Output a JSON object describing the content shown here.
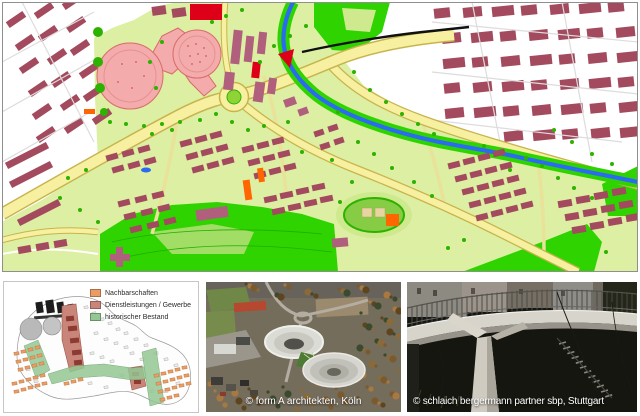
{
  "master_plan_map": {
    "description": "Urban master plan map with existing city fabric, new quarters, parks, main axis road, railway and river",
    "palette": {
      "existing_building": "#a34a5e",
      "new_building_red": "#dd0018",
      "special_building_mauve": "#b0607c",
      "planning_area": "#dcefa2",
      "park_green": "#2ed300",
      "tree_green": "#2db200",
      "road_fill": "#f6f0a0",
      "road_edge": "#c8b44e",
      "river_blue": "#2b6bf2",
      "circle_pink": "#f4abab",
      "circle_pink_edge": "#d96a6a",
      "accent_orange": "#ff6600",
      "railway_black": "#101010",
      "sports_field": "#86cc44"
    }
  },
  "concept_panel": {
    "legend": {
      "items": [
        {
          "label": "Nachbarschaften",
          "color": "#eb9c63"
        },
        {
          "label": "Dienstleistungen / Gewerbe",
          "color": "#c9857a"
        },
        {
          "label": "historischer Bestand",
          "color": "#94c794"
        }
      ]
    }
  },
  "aerial_panel": {
    "caption": "© form A architekten, Köln"
  },
  "bridge_panel": {
    "caption": "© schlaich bergermann partner sbp, Stuttgart"
  }
}
